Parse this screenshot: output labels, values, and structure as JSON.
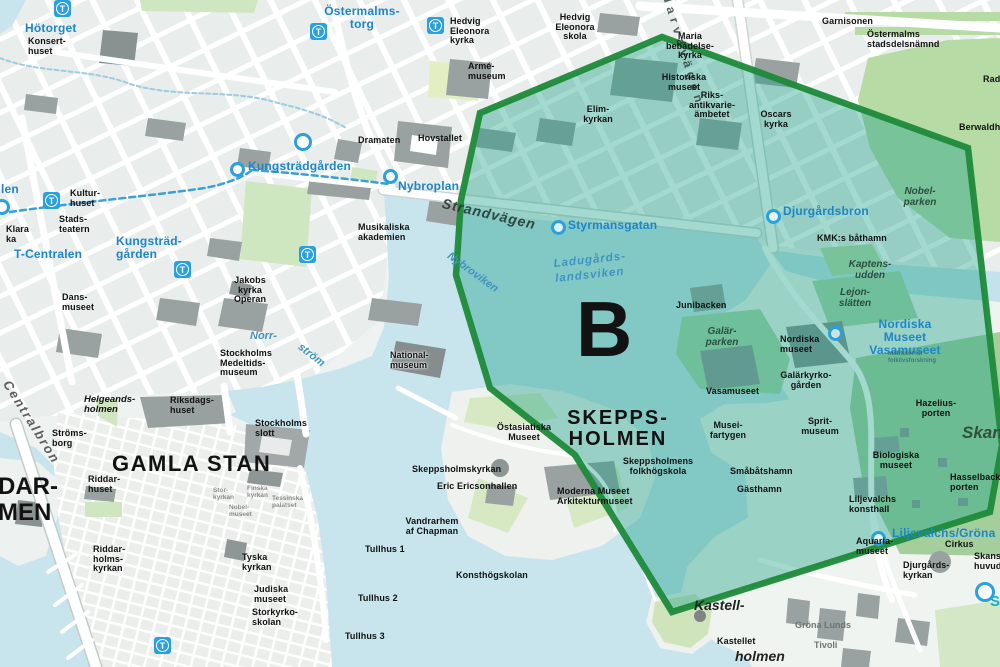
{
  "map": {
    "zone": {
      "letter": "B",
      "fill": "#18a086",
      "fill_opacity": 0.4,
      "border_color": "#1e8a39",
      "points": "480,113 662,37 968,148 1002,445 990,512 672,612 575,455 490,388 456,275 461,200"
    },
    "colors": {
      "water": "#c8e5ee",
      "land": "#eef2f0",
      "park": "#cfe7c1",
      "park_dark": "#abd4a8",
      "building": "#9aa1a1",
      "metro_blue": "#2aa0dc",
      "label_blue": "#1d86c8",
      "zone_border": "#1e8a39"
    },
    "metro_icon_letter": "T",
    "metro_icons": [
      {
        "x": 62,
        "y": 8
      },
      {
        "x": 318,
        "y": 31
      },
      {
        "x": 435,
        "y": 25
      },
      {
        "x": 51,
        "y": 200
      },
      {
        "x": 182,
        "y": 269
      },
      {
        "x": 307,
        "y": 254
      },
      {
        "x": 162,
        "y": 645
      }
    ],
    "station_circles": [
      {
        "x": 237,
        "y": 169,
        "d": 15
      },
      {
        "x": 303,
        "y": 142,
        "d": 18
      },
      {
        "x": 390,
        "y": 176,
        "d": 15
      },
      {
        "x": 2,
        "y": 207,
        "d": 16
      },
      {
        "x": 558,
        "y": 227,
        "d": 15
      },
      {
        "x": 773,
        "y": 216,
        "d": 15
      },
      {
        "x": 835,
        "y": 333,
        "d": 15
      },
      {
        "x": 878,
        "y": 538,
        "d": 15
      },
      {
        "x": 985,
        "y": 592,
        "d": 20
      }
    ],
    "labels": [
      {
        "text": "Hötorget",
        "x": 25,
        "y": 22,
        "style": "metro"
      },
      {
        "text": "Konsert-\nhuset",
        "x": 28,
        "y": 37,
        "style": "poi"
      },
      {
        "text": "Östermalms-\ntorg",
        "x": 362,
        "y": 5,
        "style": "metro",
        "align": "center"
      },
      {
        "text": "Hedvig\nEleonora\nkyrka",
        "x": 450,
        "y": 17,
        "style": "poi"
      },
      {
        "text": "Hedvig\nEleonora\nskola",
        "x": 575,
        "y": 13,
        "style": "poi",
        "align": "center"
      },
      {
        "text": "Armé-\nmuseum",
        "x": 468,
        "y": 62,
        "style": "poi"
      },
      {
        "text": "Dramaten",
        "x": 358,
        "y": 136,
        "style": "poi"
      },
      {
        "text": "Hovstallet",
        "x": 418,
        "y": 134,
        "style": "poi"
      },
      {
        "text": "Musikaliska\nakademien",
        "x": 358,
        "y": 223,
        "style": "poi"
      },
      {
        "text": "Kungsträdgården",
        "x": 248,
        "y": 160,
        "style": "metro"
      },
      {
        "text": "Nybroplan",
        "x": 398,
        "y": 180,
        "style": "metro"
      },
      {
        "text": "len",
        "x": 1,
        "y": 183,
        "style": "metro"
      },
      {
        "text": "Klara\nka",
        "x": 6,
        "y": 225,
        "style": "poi"
      },
      {
        "text": "T-Centralen",
        "x": 14,
        "y": 248,
        "style": "metro"
      },
      {
        "text": "Kungsträd-\ngården",
        "x": 116,
        "y": 235,
        "style": "metro"
      },
      {
        "text": "Kultur-\nhuset",
        "x": 70,
        "y": 189,
        "style": "poi"
      },
      {
        "text": "Stads-\nteatern",
        "x": 59,
        "y": 215,
        "style": "poi"
      },
      {
        "text": "Jakobs\nkyrka\nOperan",
        "x": 250,
        "y": 276,
        "style": "poi",
        "align": "center"
      },
      {
        "text": "Dans-\nmuseet",
        "x": 62,
        "y": 293,
        "style": "poi"
      },
      {
        "text": "Norr-",
        "x": 250,
        "y": 330,
        "style": "water"
      },
      {
        "text": "ström",
        "x": 303,
        "y": 341,
        "style": "water",
        "rot": 38
      },
      {
        "text": "Stockholms\nMedeltids-\nmuseum",
        "x": 220,
        "y": 349,
        "style": "poi"
      },
      {
        "text": "National-\nmuseum",
        "x": 390,
        "y": 351,
        "style": "poi-halo"
      },
      {
        "text": "Helgeands-\nholmen",
        "x": 84,
        "y": 395,
        "style": "ital-poi"
      },
      {
        "text": "Riksdags-\nhuset",
        "x": 170,
        "y": 396,
        "style": "poi"
      },
      {
        "text": "Stockholms\nslott",
        "x": 255,
        "y": 419,
        "style": "poi"
      },
      {
        "text": "Ströms-\nborg",
        "x": 52,
        "y": 429,
        "style": "poi"
      },
      {
        "text": "GAMLA STAN",
        "x": 112,
        "y": 452,
        "style": "district"
      },
      {
        "text": "DAR-\nMEN",
        "x": -2,
        "y": 474,
        "style": "district-xl"
      },
      {
        "text": "Riddar-\nhuset",
        "x": 88,
        "y": 475,
        "style": "poi"
      },
      {
        "text": "Riddar-\nholms-\nkyrkan",
        "x": 93,
        "y": 545,
        "style": "poi"
      },
      {
        "text": "Stor-\nkyrkan",
        "x": 213,
        "y": 487,
        "style": "poi-faint"
      },
      {
        "text": "Finska\nkyrkan",
        "x": 247,
        "y": 485,
        "style": "poi-faint"
      },
      {
        "text": "Tessinska\npalatset",
        "x": 272,
        "y": 495,
        "style": "poi-faint"
      },
      {
        "text": "Nobel-\nmuseet",
        "x": 229,
        "y": 504,
        "style": "poi-faint"
      },
      {
        "text": "Tyska\nkyrkan",
        "x": 242,
        "y": 553,
        "style": "poi"
      },
      {
        "text": "Judiska\nmuseet",
        "x": 254,
        "y": 585,
        "style": "poi"
      },
      {
        "text": "Storkyrko-\nskolan",
        "x": 252,
        "y": 608,
        "style": "poi"
      },
      {
        "text": "Centralbron",
        "x": 12,
        "y": 378,
        "style": "cen-rot",
        "rot": 58
      },
      {
        "text": "Strandvägen",
        "x": 444,
        "y": 196,
        "style": "strand",
        "rot": 13
      },
      {
        "text": "Narvavägen",
        "x": 672,
        "y": -8,
        "style": "narva",
        "rot": 73
      },
      {
        "text": "Maria\nbebådelse-\nkyrka",
        "x": 690,
        "y": 32,
        "style": "poi",
        "align": "center"
      },
      {
        "text": "Historiska\nmuseet",
        "x": 684,
        "y": 73,
        "style": "poi",
        "align": "center"
      },
      {
        "text": "Riks-\nantikvarie-\nämbetet",
        "x": 712,
        "y": 91,
        "style": "poi",
        "align": "center"
      },
      {
        "text": "Oscars\nkyrka",
        "x": 776,
        "y": 110,
        "style": "poi",
        "align": "center"
      },
      {
        "text": "Garnisonen",
        "x": 822,
        "y": 17,
        "style": "poi"
      },
      {
        "text": "Östermalms\nstadsdelsnämnd",
        "x": 867,
        "y": 30,
        "style": "poi"
      },
      {
        "text": "Elim-\nkyrkan",
        "x": 598,
        "y": 105,
        "style": "poi",
        "align": "center"
      },
      {
        "text": "Styrmansgatan",
        "x": 568,
        "y": 219,
        "style": "metro"
      },
      {
        "text": "Nybroviken",
        "x": 452,
        "y": 250,
        "style": "water",
        "rot": 36
      },
      {
        "text": "Ladugårds-\nlandsviken",
        "x": 553,
        "y": 257,
        "style": "water-lg",
        "rot": -6
      },
      {
        "text": "B",
        "x": 576,
        "y": 296,
        "style": "zone-letter"
      },
      {
        "text": "Junibacken",
        "x": 676,
        "y": 301,
        "style": "poi"
      },
      {
        "text": "Galär-\nparken",
        "x": 722,
        "y": 327,
        "style": "park",
        "align": "center"
      },
      {
        "text": "Djurgårdsbron",
        "x": 783,
        "y": 205,
        "style": "metro"
      },
      {
        "text": "KMK:s båthamn",
        "x": 817,
        "y": 234,
        "style": "poi"
      },
      {
        "text": "Nobel-\nparken",
        "x": 920,
        "y": 187,
        "style": "park",
        "align": "center"
      },
      {
        "text": "Kaptens-\nudden",
        "x": 870,
        "y": 260,
        "style": "park",
        "align": "center"
      },
      {
        "text": "Lejon-\nslätten",
        "x": 855,
        "y": 288,
        "style": "park",
        "align": "center"
      },
      {
        "text": "Nordiska Museet\nVasamuseet",
        "x": 905,
        "y": 318,
        "style": "metro",
        "align": "center"
      },
      {
        "text": "Institutet för\nfolklivsforskning",
        "x": 888,
        "y": 351,
        "style": "tiny"
      },
      {
        "text": "Nordiska\nmuseet",
        "x": 780,
        "y": 335,
        "style": "poi"
      },
      {
        "text": "Galärkyrko-\ngården",
        "x": 806,
        "y": 371,
        "style": "poi",
        "align": "center"
      },
      {
        "text": "Vasamuseet",
        "x": 706,
        "y": 387,
        "style": "poi"
      },
      {
        "text": "Musei-\nfartygen",
        "x": 728,
        "y": 421,
        "style": "poi",
        "align": "center"
      },
      {
        "text": "Sprit-\nmuseum",
        "x": 820,
        "y": 417,
        "style": "poi",
        "align": "center"
      },
      {
        "text": "Småbåtshamn",
        "x": 730,
        "y": 467,
        "style": "poi"
      },
      {
        "text": "Gästhamn",
        "x": 737,
        "y": 485,
        "style": "poi"
      },
      {
        "text": "Hazelius-\nporten",
        "x": 936,
        "y": 399,
        "style": "poi",
        "align": "center"
      },
      {
        "text": "Biologiska\nmuseet",
        "x": 896,
        "y": 451,
        "style": "poi",
        "align": "center"
      },
      {
        "text": "Hasselbacks-\nporten",
        "x": 950,
        "y": 473,
        "style": "poi"
      },
      {
        "text": "Skansen",
        "x": 962,
        "y": 424,
        "style": "skansen"
      },
      {
        "text": "Liljevalchs\nkonsthall",
        "x": 849,
        "y": 495,
        "style": "poi"
      },
      {
        "text": "Liljevalchs/Gröna",
        "x": 892,
        "y": 527,
        "style": "metro"
      },
      {
        "text": "Aquaria-\nmuseet",
        "x": 856,
        "y": 537,
        "style": "poi"
      },
      {
        "text": "Cirkus",
        "x": 945,
        "y": 540,
        "style": "poi"
      },
      {
        "text": "Djurgårds-\nkyrkan",
        "x": 903,
        "y": 561,
        "style": "poi"
      },
      {
        "text": "Skansens\nhuvudentré",
        "x": 974,
        "y": 552,
        "style": "poi"
      },
      {
        "text": "S",
        "x": 990,
        "y": 594,
        "style": "smark"
      },
      {
        "text": "SKEPPS-\nHOLMEN",
        "x": 618,
        "y": 408,
        "style": "district2",
        "align": "center"
      },
      {
        "text": "Östasiatiska\nMuseet",
        "x": 524,
        "y": 423,
        "style": "poi",
        "align": "center"
      },
      {
        "text": "Skeppsholmskyrkan",
        "x": 412,
        "y": 465,
        "style": "poi"
      },
      {
        "text": "Eric Ericsonhallen",
        "x": 437,
        "y": 482,
        "style": "poi"
      },
      {
        "text": "Skeppsholmens\nfolkhögskola",
        "x": 658,
        "y": 457,
        "style": "poi",
        "align": "center"
      },
      {
        "text": "Moderna Museet\nArkitekturmuseet",
        "x": 557,
        "y": 487,
        "style": "poi"
      },
      {
        "text": "Vandrarhem\naf Chapman",
        "x": 432,
        "y": 517,
        "style": "poi",
        "align": "center"
      },
      {
        "text": "Tullhus 1",
        "x": 365,
        "y": 545,
        "style": "poi"
      },
      {
        "text": "Tullhus 2",
        "x": 358,
        "y": 594,
        "style": "poi"
      },
      {
        "text": "Tullhus 3",
        "x": 345,
        "y": 632,
        "style": "poi"
      },
      {
        "text": "Konsthögskolan",
        "x": 456,
        "y": 571,
        "style": "poi"
      },
      {
        "text": "Kastell-",
        "x": 694,
        "y": 598,
        "style": "kastell"
      },
      {
        "text": "holmen",
        "x": 735,
        "y": 649,
        "style": "kastell"
      },
      {
        "text": "Kastellet",
        "x": 717,
        "y": 637,
        "style": "poi"
      },
      {
        "text": "Gröna Lunds",
        "x": 795,
        "y": 621,
        "style": "gray"
      },
      {
        "text": "Tivoli",
        "x": 814,
        "y": 641,
        "style": "gray"
      },
      {
        "text": "Berwaldhallen",
        "x": 959,
        "y": 123,
        "style": "poi"
      },
      {
        "text": "Radiohuset",
        "x": 983,
        "y": 75,
        "style": "poi"
      }
    ]
  }
}
